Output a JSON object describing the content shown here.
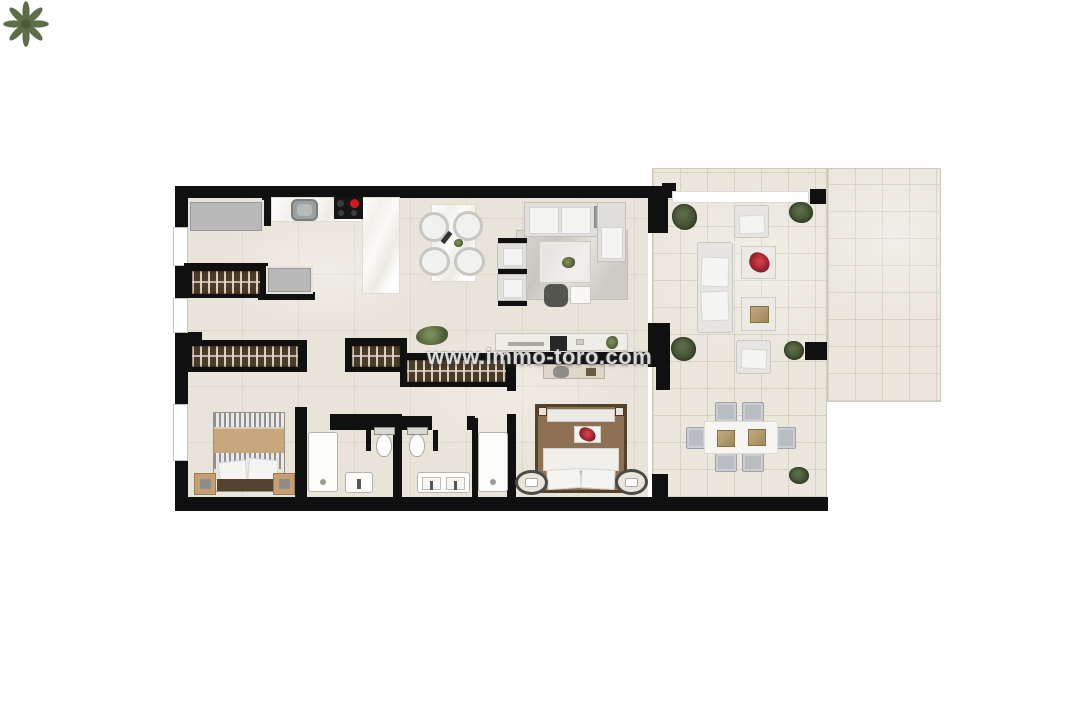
{
  "watermark": {
    "text": "www.immo-toro.com"
  },
  "palette": {
    "wall": "#101010",
    "floor_interior": "#e9e4da",
    "floor_terrace": "#ebe7dd",
    "terrace_grid": "#d7d2c6",
    "counter_white": "#f8f7f3",
    "appliance_gray": "#b9b9b9",
    "wardrobe_dark": "#4a3a28",
    "wardrobe_slat": "#d9cfbe",
    "sofa_gray": "#e0dfdb",
    "cushion_white": "#f4f4f2",
    "rug_gray": "#d5d2cc",
    "wood_tan": "#c7a87c",
    "bed_brown": "#8d7152",
    "plant_green": "#46542f",
    "palm_green": "#5a6b42",
    "stove_black": "#161616",
    "burner_red": "#d41623",
    "outdoor_chair_gray": "#b9bdc2",
    "tray_beige": "#b09a6e"
  },
  "plan": {
    "type": "apartment-floor-plan",
    "rooms": [
      {
        "name": "utility-entry",
        "items": [
          "appliance-counter",
          "built-in-wardrobe",
          "washer-unit"
        ]
      },
      {
        "name": "kitchen",
        "items": [
          "counter",
          "sink",
          "stove",
          "island-peninsula"
        ]
      },
      {
        "name": "dining-area",
        "items": [
          "dining-table",
          "dining-chair",
          "dining-chair",
          "dining-chair",
          "dining-chair"
        ]
      },
      {
        "name": "living-room",
        "items": [
          "corner-sofa",
          "armchair",
          "armchair",
          "rug",
          "coffee-table",
          "pouf",
          "side-table",
          "tv-sideboard",
          "floor-plant"
        ]
      },
      {
        "name": "hallway",
        "items": [
          "built-in-wardrobe",
          "built-in-wardrobe"
        ]
      },
      {
        "name": "bedroom-1",
        "items": [
          "double-bed",
          "nightstand",
          "nightstand",
          "built-in-wardrobe"
        ]
      },
      {
        "name": "bathroom-1",
        "items": [
          "shower",
          "washbasin",
          "toilet"
        ]
      },
      {
        "name": "bathroom-2",
        "items": [
          "toilet",
          "double-washbasin",
          "shower"
        ]
      },
      {
        "name": "bedroom-2",
        "items": [
          "double-bed",
          "round-nightstand",
          "round-nightstand",
          "dresser",
          "desk-chair"
        ]
      },
      {
        "name": "terrace",
        "items": [
          "pergola-beam",
          "outdoor-armchair",
          "outdoor-armchair",
          "outdoor-sofa",
          "coffee-table-red-plant",
          "coffee-table-tray",
          "outdoor-dining-table",
          "outdoor-chair",
          "outdoor-chair",
          "outdoor-chair",
          "outdoor-chair",
          "outdoor-chair",
          "outdoor-chair",
          "palm-plant",
          "bush",
          "bush",
          "bush",
          "bush",
          "bush"
        ]
      }
    ]
  }
}
